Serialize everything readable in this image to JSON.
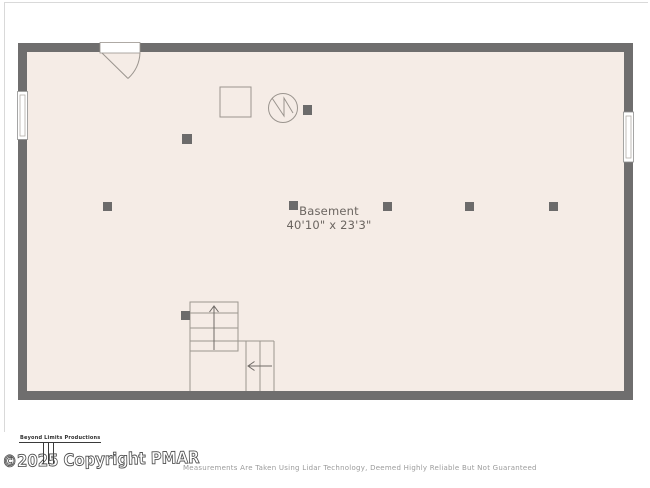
{
  "room": {
    "name": "Basement",
    "dimensions": "40'10\" x 23'3\""
  },
  "footer": {
    "brand": "Beyond Limits Productions",
    "copyright": "©2025 Copyright PMAR",
    "disclaimer": "Measurements Are Taken Using Lidar Technology, Deemed Highly Reliable But Not Guaranteed"
  },
  "colors": {
    "floor": "#f5ece6",
    "wall": "#6f6e6e",
    "symbol_line": "#9a948e",
    "label_text": "#6b6560",
    "disclaimer_text": "#9b9b9b",
    "frame_line": "#d9d9d9"
  },
  "symbols": {
    "door": "door-swing-icon",
    "window_count": 2,
    "support_post_count": 8,
    "water_heater": "circle-zigzag-icon",
    "utility_box": "square-outline-icon",
    "stair_up_arrow": "arrow-up-icon",
    "stair_left_arrow": "arrow-left-icon"
  }
}
